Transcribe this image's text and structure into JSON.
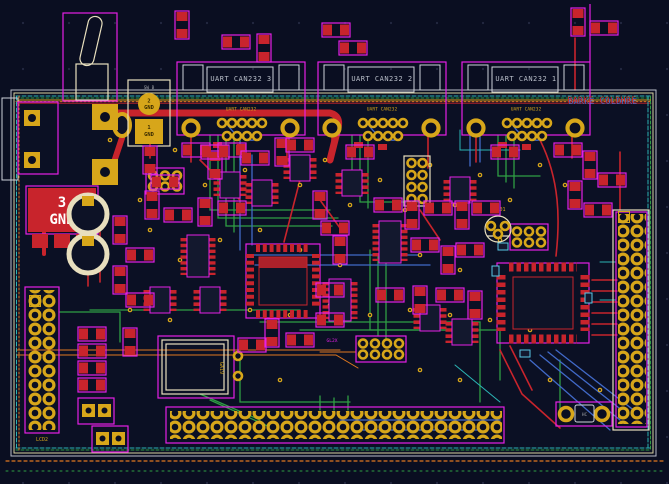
{
  "app": {
    "view": "pcb-layout-canvas"
  },
  "palette": {
    "background": "#0a0e21",
    "copper_top": "#c8242c",
    "copper_bottom": "#4169c8",
    "inner_layer": "#2f9e44",
    "aux_cyan": "#2bb5b5",
    "orange": "#e07820",
    "pad_gold": "#d7a61a",
    "silkscreen": "#cfd3dc",
    "courtyard": "#e520e5",
    "fab_cream": "#e8dfbe"
  },
  "board": {
    "title_overlay": "BARKE COLDHRE",
    "connectors": [
      {
        "label": "UART CAN232 3",
        "sublabel": "UART CAN232"
      },
      {
        "label": "UART CAN232 2",
        "sublabel": "UART CAN232"
      },
      {
        "label": "UART CAN232 1",
        "sublabel": "UART CAN232"
      }
    ],
    "power_switch": {
      "name": "SW_B",
      "pad2_num": "2",
      "pad2_net": "GND",
      "pad1_num": "1",
      "pad1_net": "GND"
    },
    "gnd_block": {
      "pin": "3",
      "net": "GND"
    },
    "labels": {
      "left_header": "LCD2",
      "regulator": "LV101",
      "jumper": "GL2X",
      "crystal": "HC",
      "lcd_panel": "GA19"
    }
  }
}
